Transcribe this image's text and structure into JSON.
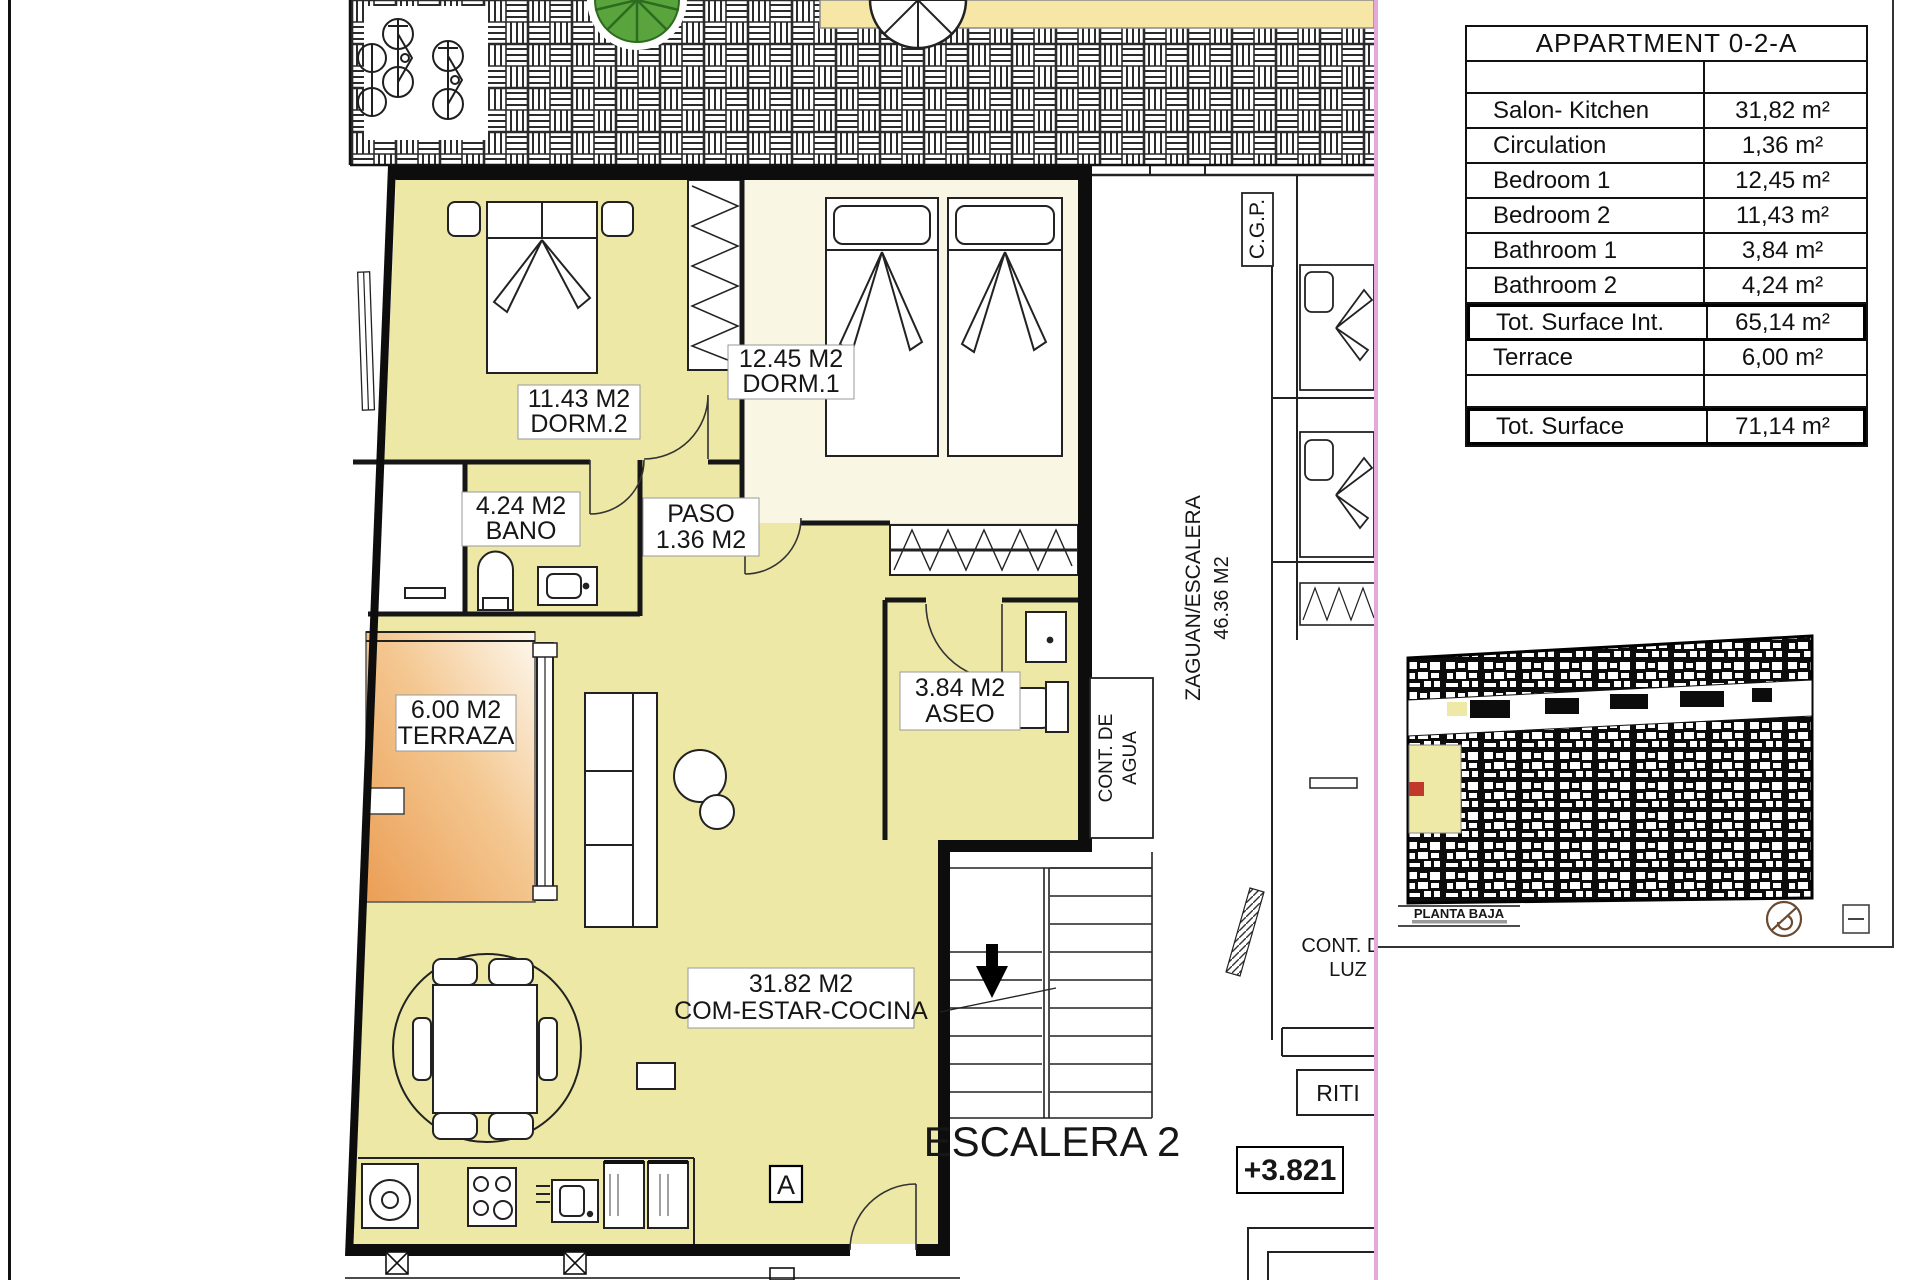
{
  "table": {
    "title": "APPARTMENT 0-2-A",
    "rows": [
      {
        "label": "",
        "value": "",
        "empty": true
      },
      {
        "label": "Salon- Kitchen",
        "value": "31,82 m²"
      },
      {
        "label": "Circulation",
        "value": "1,36 m²"
      },
      {
        "label": "Bedroom 1",
        "value": "12,45 m²"
      },
      {
        "label": "Bedroom 2",
        "value": "11,43 m²"
      },
      {
        "label": "Bathroom 1",
        "value": "3,84 m²"
      },
      {
        "label": "Bathroom 2",
        "value": "4,24 m²"
      },
      {
        "label": "Tot. Surface Int.",
        "value": "65,14 m²",
        "bold": true
      },
      {
        "label": "Terrace",
        "value": "6,00 m²"
      },
      {
        "label": "",
        "value": "",
        "empty": true
      },
      {
        "label": "Tot. Surface",
        "value": "71,14 m²",
        "bold": true
      }
    ]
  },
  "rooms": {
    "dorm2": {
      "area": "11.43 M2",
      "name": "DORM.2"
    },
    "dorm1": {
      "area": "12.45 M2",
      "name": "DORM.1"
    },
    "bano": {
      "area": "4.24 M2",
      "name": "BANO"
    },
    "paso": {
      "name": "PASO",
      "area": "1.36 M2"
    },
    "aseo": {
      "area": "3.84 M2",
      "name": "ASEO"
    },
    "terraza": {
      "area": "6.00 M2",
      "name": "TERRAZA"
    },
    "salon": {
      "area": "31.82 M2",
      "name": "COM-ESTAR-COCINA"
    }
  },
  "annotations": {
    "escalera": "ESCALERA 2",
    "level": "+3.821",
    "zaguan_line1": "ZAGUAN/ESCALERA",
    "zaguan_line2": "46.36 M2",
    "cgp": "C.G.P.",
    "cont_agua_line1": "CONT. DE",
    "cont_agua_line2": "AGUA",
    "cont_luz_line1": "CONT. DE",
    "cont_luz_line2": "LUZ",
    "riti": "RITI",
    "section_a": "A",
    "planta_baja": "PLANTA BAJA"
  },
  "colors": {
    "room_yellow": "#eee8a6",
    "dorm1_cream": "#f9f6e4",
    "terrace_orange": "#eb9e55",
    "canopy_yellow": "#f6e7a6",
    "tree_green": "#5aa43e",
    "highlight_pink_line": "#e3a9dd",
    "wall_black": "#0d0d0d"
  }
}
